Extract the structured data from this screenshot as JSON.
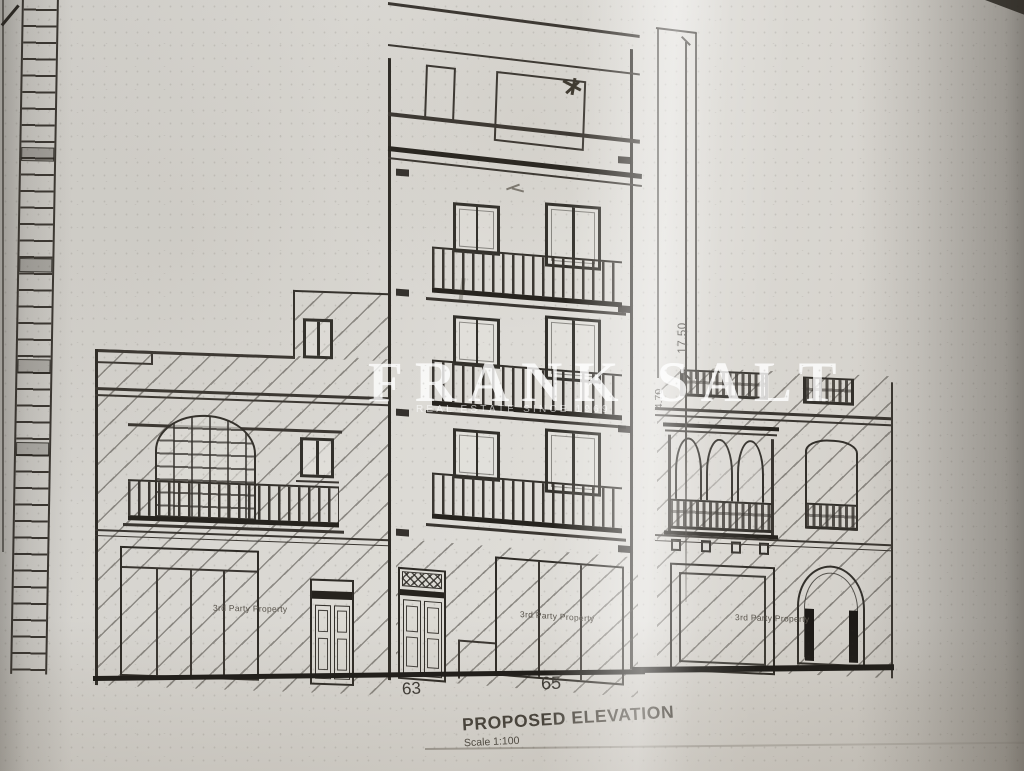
{
  "watermark": {
    "name": "FRANK SALT",
    "tagline": "REAL ESTATE SINCE 1969"
  },
  "title_block": {
    "title": "PROPOSED ELEVATION",
    "scale": "Scale 1:100"
  },
  "street_numbers": {
    "left": "63",
    "right": "65"
  },
  "dimensions": {
    "total": "17.50",
    "upper": "4.70"
  },
  "property_labels": [
    "3rd Party Property",
    "3rd Party Property",
    "3rd Party Property"
  ],
  "colors": {
    "paper": "#d8d6d1",
    "ink": "#3a3631",
    "ink_heavy": "#26231e",
    "watermark": "#ffffff"
  }
}
